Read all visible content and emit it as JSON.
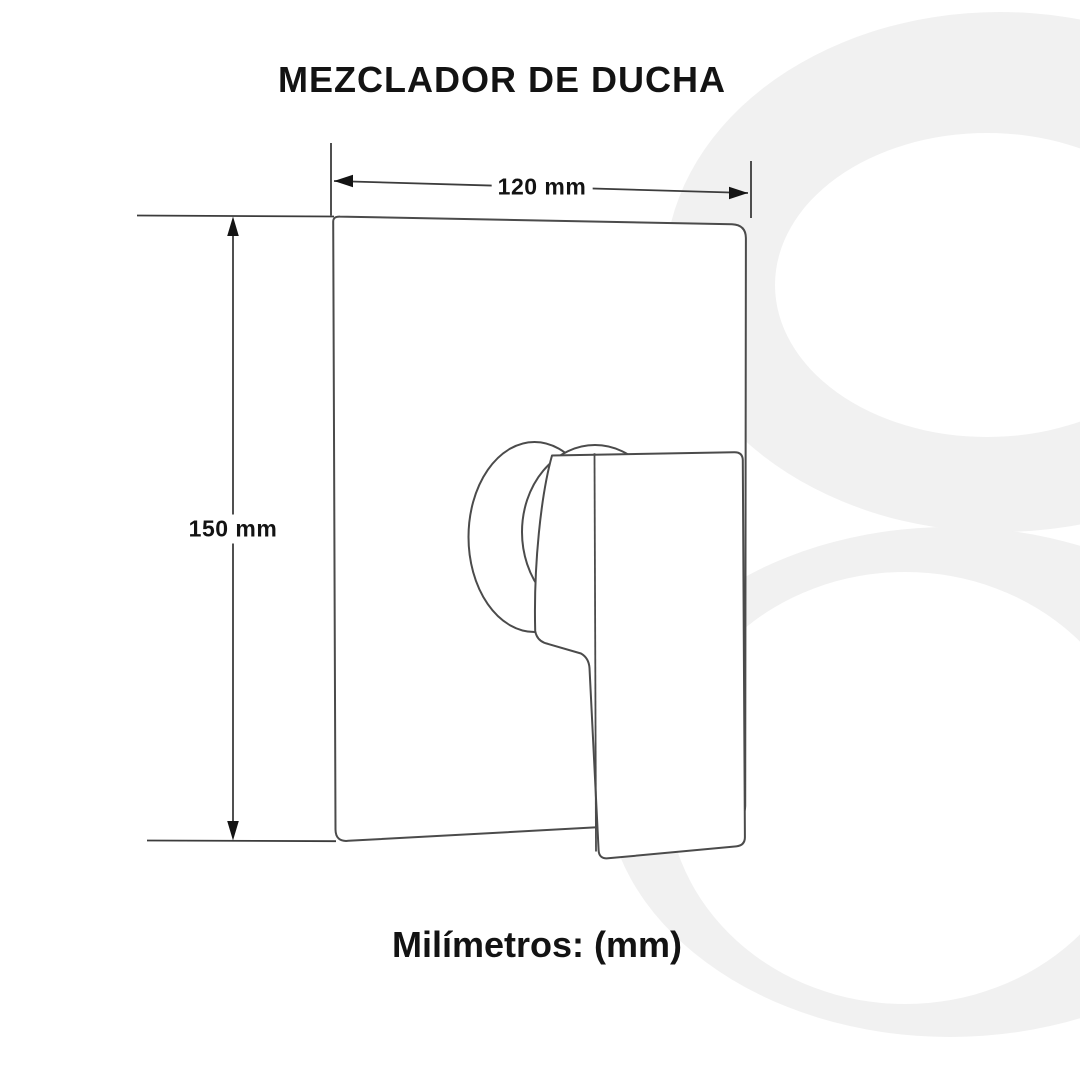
{
  "header": {
    "title": "MEZCLADOR DE DUCHA"
  },
  "diagram": {
    "subject": "shower mixer valve, front view line drawing",
    "dimensions": {
      "width_label": "120 mm",
      "height_label": "150 mm"
    },
    "watermark_shape": "8"
  },
  "footer": {
    "units_label": "Milímetros: (mm)"
  },
  "colors": {
    "background": "#ffffff",
    "drawing_line": "#4b4b4b",
    "dimension_line": "#3c3c3c",
    "arrow": "#141414",
    "text": "#131313",
    "watermark": "#f1f1f1"
  }
}
